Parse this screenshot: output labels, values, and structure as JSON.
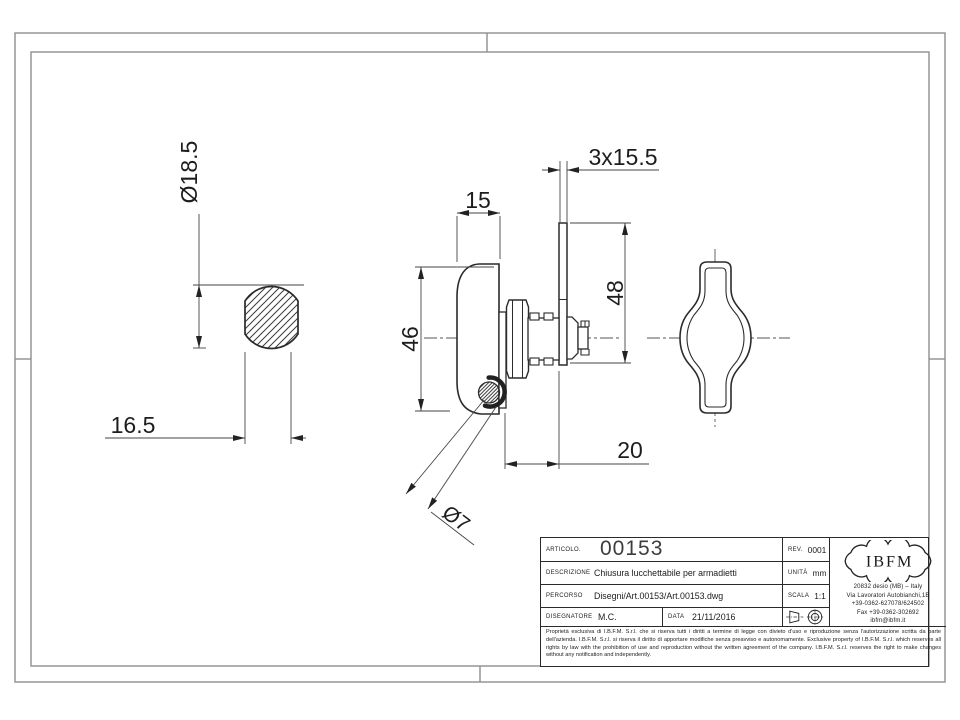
{
  "drawing": {
    "dimensions": {
      "left_view_diameter": "Ø18.5",
      "left_view_width": "16.5",
      "side_view_depth": "15",
      "side_view_height": "46",
      "cam_length": "48",
      "cam_section": "3x15.5",
      "cam_offset": "20",
      "padlock_hole": "Ø7"
    }
  },
  "title_block": {
    "articolo_label": "ARTICOLO.",
    "articolo_value": "00153",
    "rev_label": "REV.",
    "rev_value": "0001",
    "descrizione_label": "DESCRIZIONE",
    "descrizione_value": "Chiusura lucchettabile per armadietti",
    "unita_label": "UNITÀ",
    "unita_value": "mm",
    "percorso_label": "PERCORSO",
    "percorso_value": "Disegni/Art.00153/Art.00153.dwg",
    "scala_label": "SCALA",
    "scala_value": "1:1",
    "disegnatore_label": "DISEGNATORE",
    "disegnatore_value": "M.C.",
    "data_label": "DATA",
    "data_value": "21/11/2016",
    "projection_symbol_icon": "first-angle-projection-symbol",
    "company": {
      "logo_text": "IBFM",
      "address_line1": "20832 desio (MB) – Italy",
      "address_line2": "Via Lavoratori Autobianchi,1B",
      "address_line3": "+39-0362-627078/624502",
      "address_line4": "Fax +39-0362-302692",
      "address_line5": "ibfm@ibfm.it"
    },
    "legal_text": "Proprietà esclusiva di I.B.F.M. S.r.l. che si riserva tutti i diritti a termine di legge con divieto d'uso e riproduzione senza l'autorizzazione scritta da parte dell'azienda. I.B.F.M. S.r.l. si riserva il diritto di apportare modifiche senza preavviso e autonomamente. Exclusive property of I.B.F.M. S.r.l. which reserves all rights by law with the prohibition of use and reproduction without the written agreement of the company. I.B.F.M. S.r.l. reserves the right to make changes without any notification and independently."
  }
}
